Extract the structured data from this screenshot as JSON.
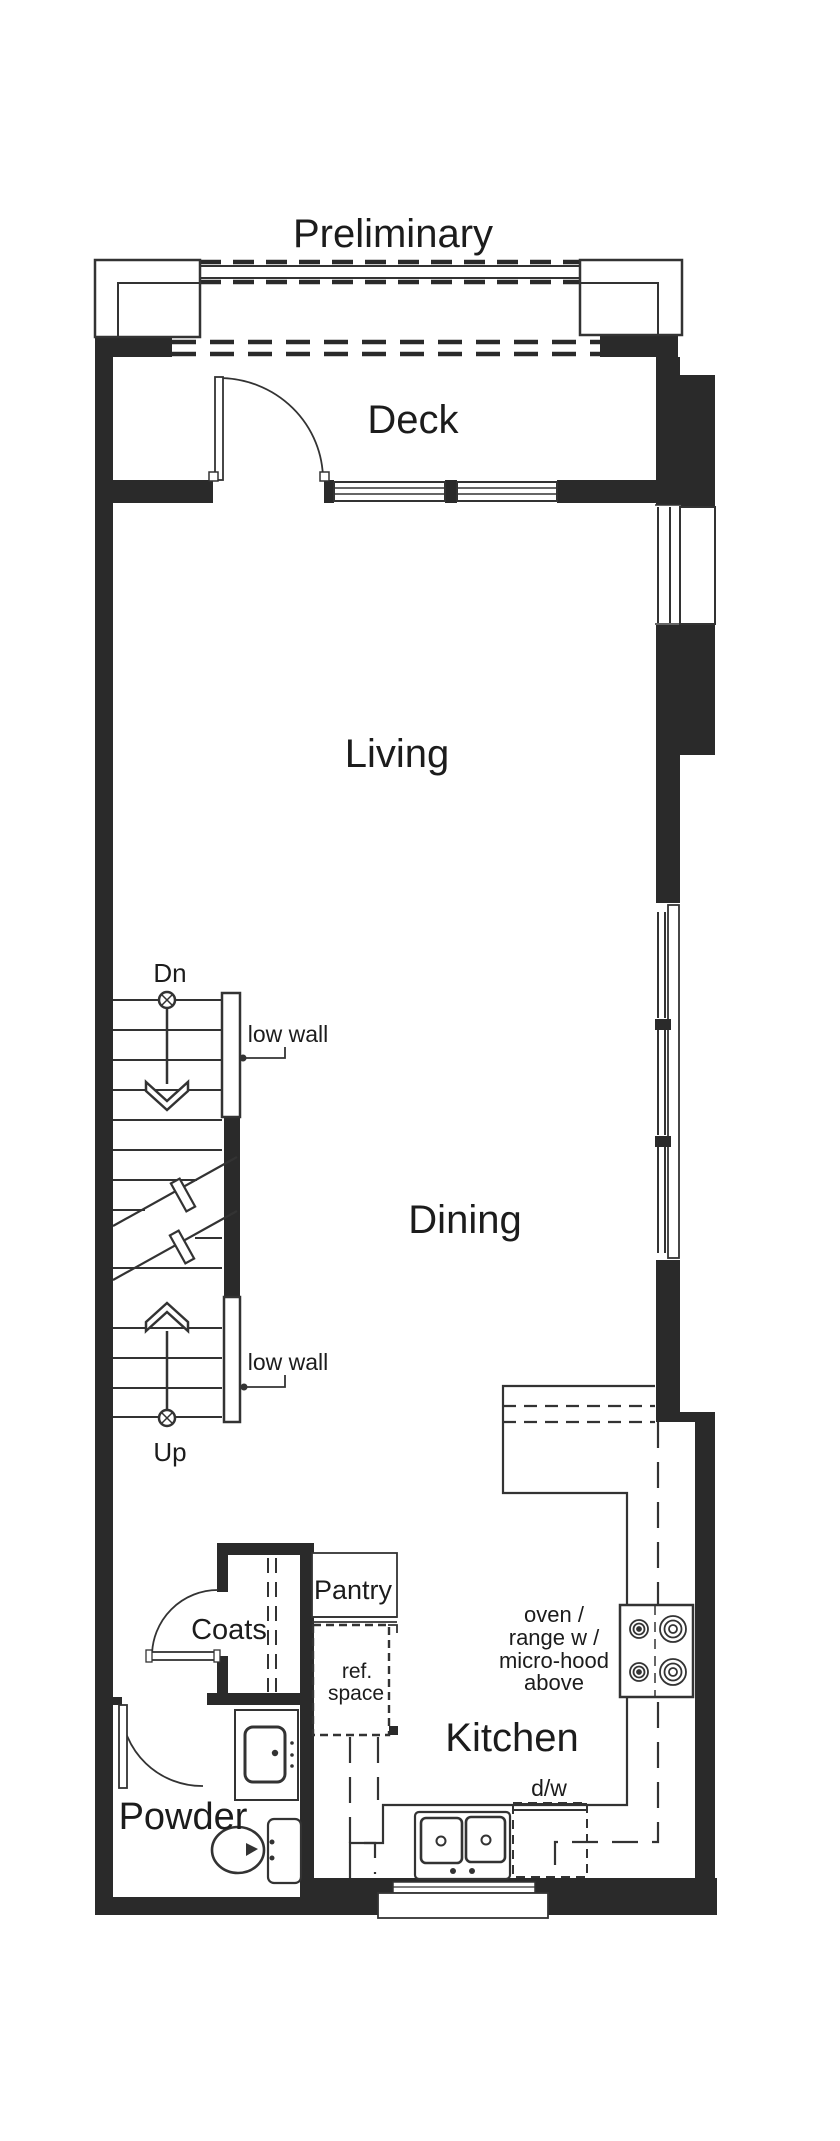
{
  "title": {
    "label": "Preliminary"
  },
  "rooms": {
    "deck": "Deck",
    "living": "Living",
    "dining": "Dining",
    "kitchen": "Kitchen",
    "powder": "Powder",
    "coats": "Coats",
    "pantry": "Pantry"
  },
  "annotations": {
    "stairs_down": "Dn",
    "stairs_up": "Up",
    "low_wall_upper": "low wall",
    "low_wall_lower": "low wall",
    "ref_space_line1": "ref.",
    "ref_space_line2": "space",
    "oven_note_line1": "oven /",
    "oven_note_line2": "range w /",
    "oven_note_line3": "micro-hood",
    "oven_note_line4": "above",
    "dishwasher": "d/w"
  },
  "colors": {
    "wall": "#2a2a2a",
    "line": "#333333",
    "text": "#1c1c1c",
    "background": "#ffffff"
  }
}
